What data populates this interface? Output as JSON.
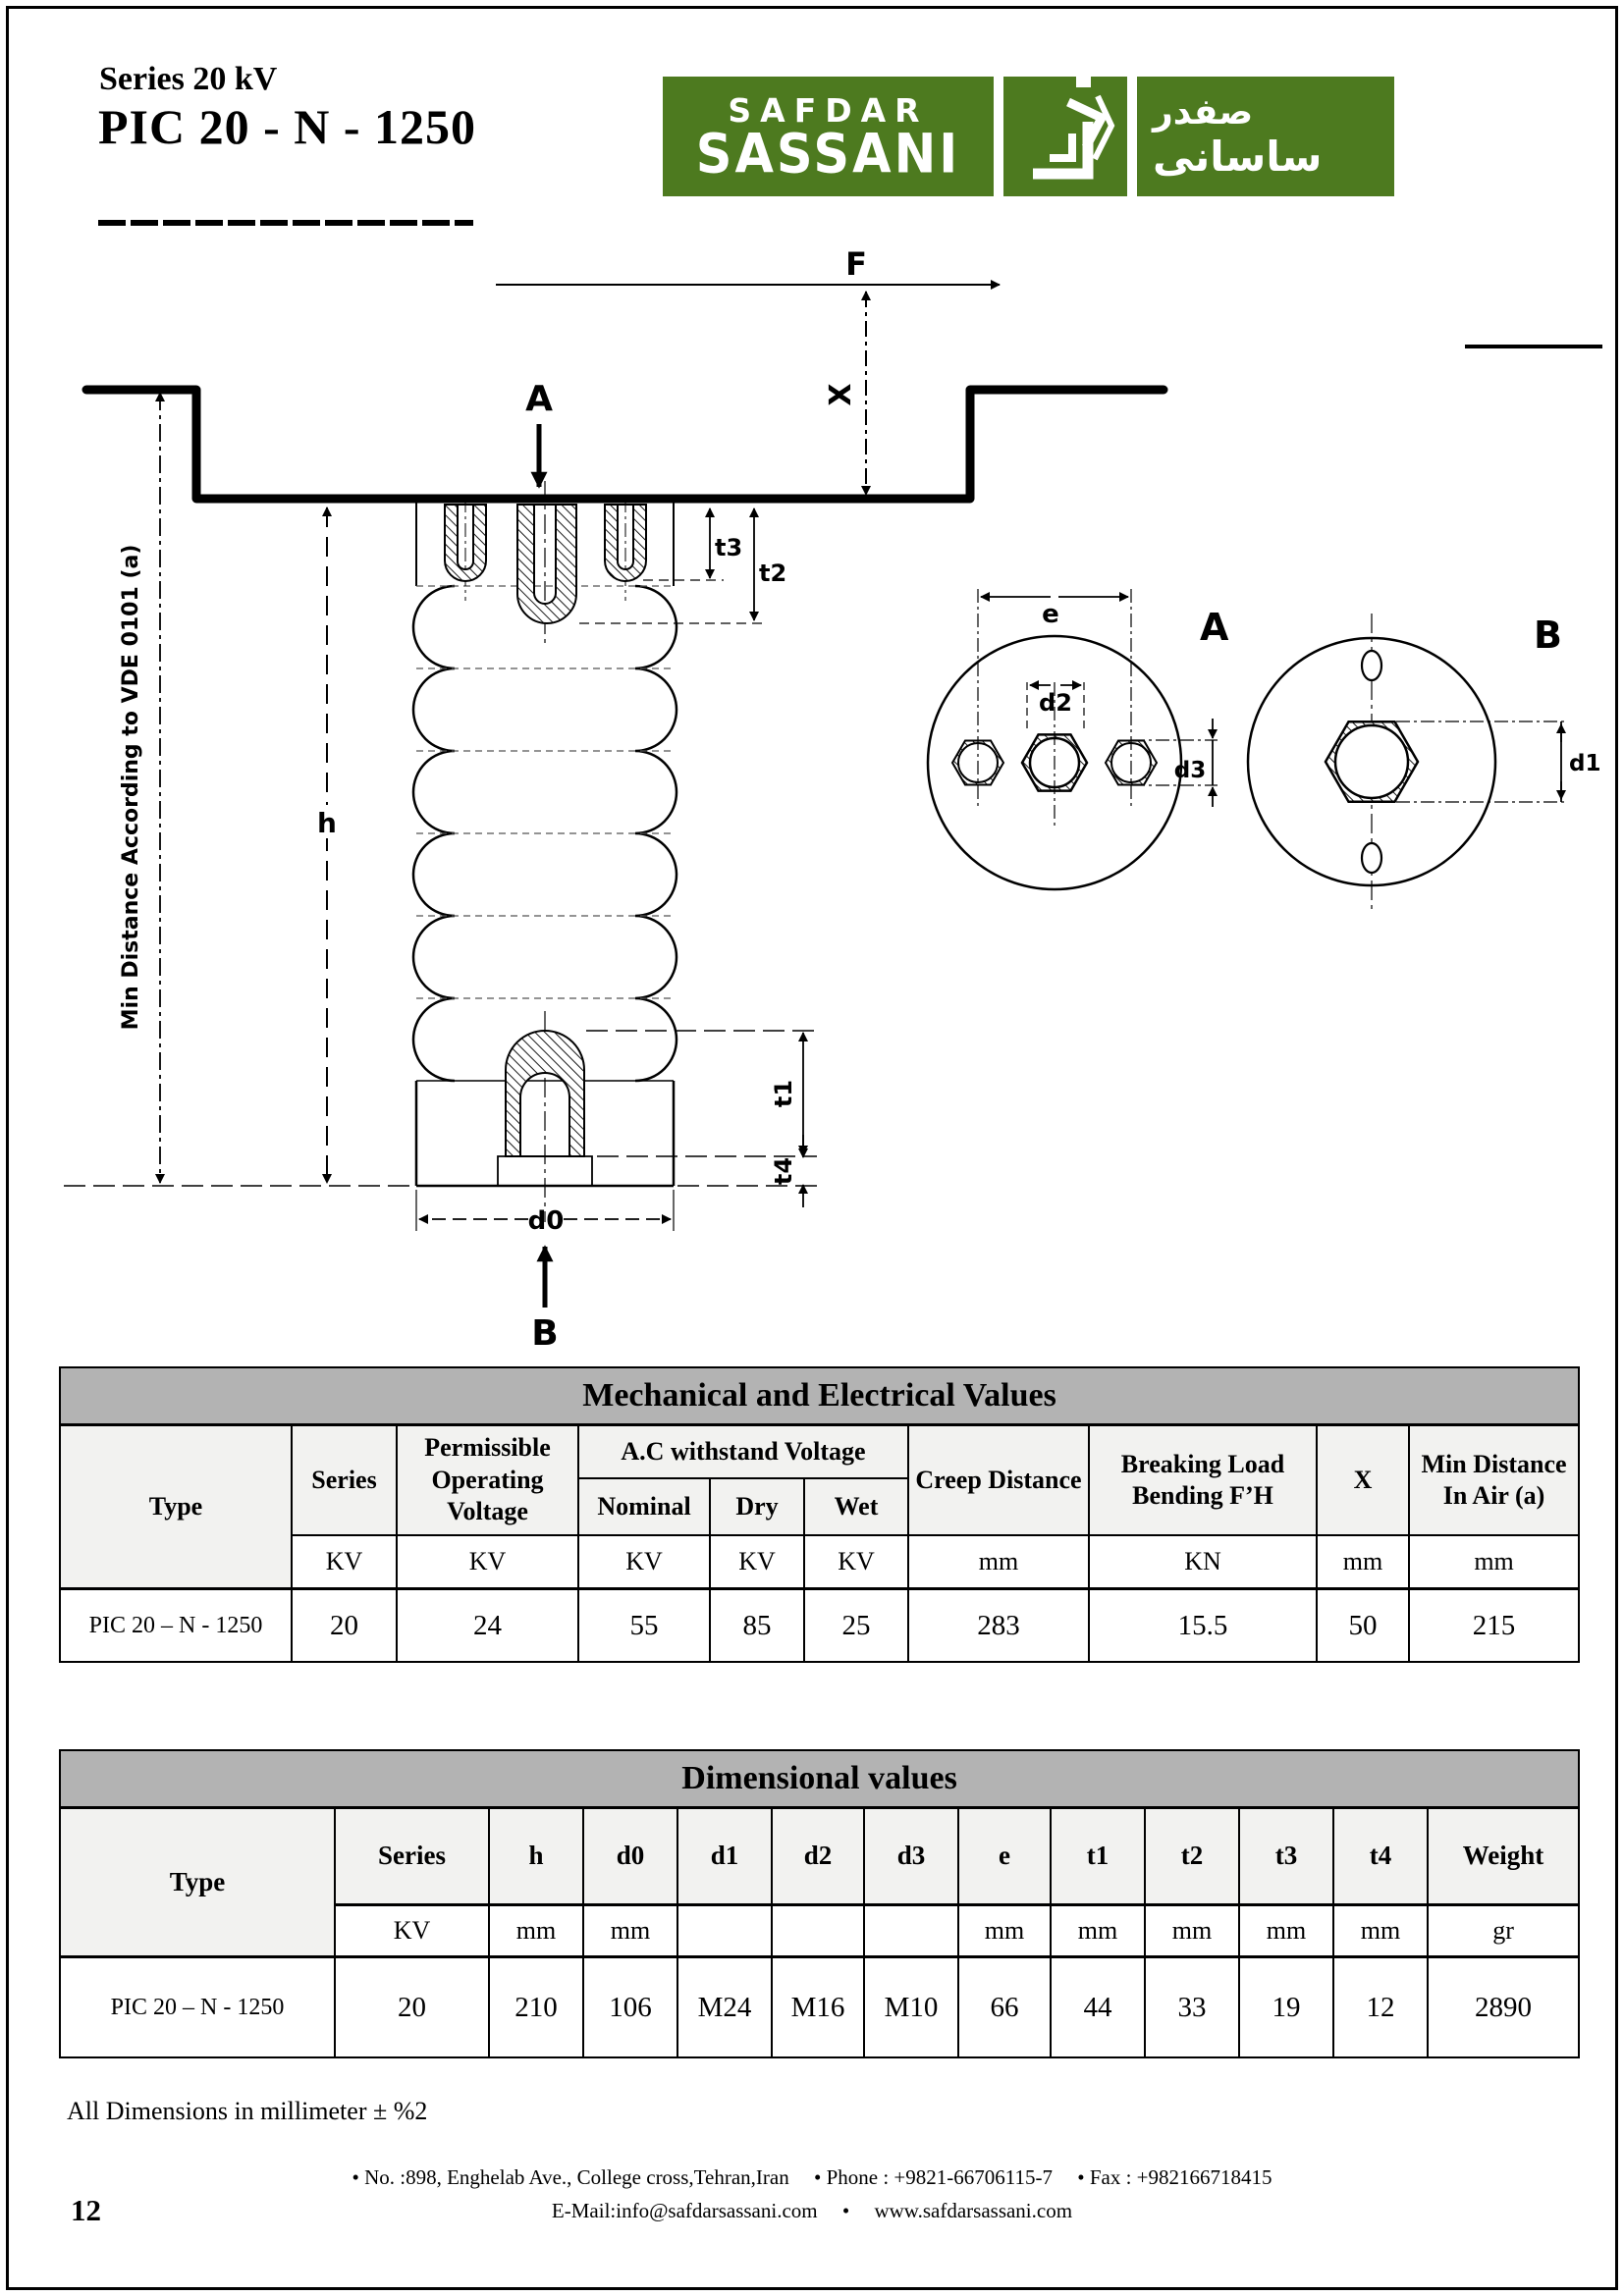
{
  "colors": {
    "brand_green": "#4d7a1f",
    "table_title_bg": "#b3b3b3",
    "table_header_bg": "#f2f2f0"
  },
  "header": {
    "series_title": "Series 20 kV",
    "product_title": "PIC 20 - N - 1250"
  },
  "logo": {
    "name_top": "SAFDAR",
    "name_bottom": "SASSANI",
    "arabic_top": "صفدر",
    "arabic_bottom": "ساسانی"
  },
  "drawing": {
    "labels": {
      "f": "F",
      "x": "X",
      "a": "A",
      "b": "B",
      "h": "h",
      "d0": "d0",
      "t1": "t1",
      "t2": "t2",
      "t3": "t3",
      "t4": "t4",
      "e": "e",
      "d1": "d1",
      "d2": "d2",
      "d3": "d3",
      "view_a": "A",
      "view_b": "B",
      "vde_note": "Min Distance According to VDE 0101 (a)"
    }
  },
  "mech_table": {
    "title": "Mechanical and Electrical Values",
    "cols": {
      "type": "Type",
      "series": "Series",
      "pov": "Permissible Operating Voltage",
      "acwv": "A.C withstand Voltage",
      "nominal": "Nominal",
      "dry": "Dry",
      "wet": "Wet",
      "creep": "Creep Distance",
      "breaking": "Breaking Load Bending F’H",
      "x": "X",
      "min_air": "Min Distance In Air (a)"
    },
    "units": [
      "KV",
      "KV",
      "KV",
      "KV",
      "KV",
      "mm",
      "KN",
      "mm",
      "mm"
    ],
    "row": [
      "PIC 20 – N - 1250",
      "20",
      "24",
      "55",
      "85",
      "25",
      "283",
      "15.5",
      "50",
      "215"
    ]
  },
  "dim_table": {
    "title": "Dimensional values",
    "type_col": "Type",
    "cols": [
      "Series",
      "h",
      "d0",
      "d1",
      "d2",
      "d3",
      "e",
      "t1",
      "t2",
      "t3",
      "t4",
      "Weight"
    ],
    "units": [
      "KV",
      "mm",
      "mm",
      "",
      "",
      "",
      "mm",
      "mm",
      "mm",
      "mm",
      "mm",
      "gr"
    ],
    "row": [
      "PIC 20 – N - 1250",
      "20",
      "210",
      "106",
      "M24",
      "M16",
      "M10",
      "66",
      "44",
      "33",
      "19",
      "12",
      "2890"
    ]
  },
  "notes": {
    "dimensions_note": "All Dimensions in millimeter ± %2"
  },
  "footer": {
    "address": "•  No. :898, Enghelab Ave., College cross,Tehran,Iran",
    "phone": "•  Phone : +9821-66706115-7",
    "fax": "•  Fax : +982166718415",
    "email": "E-Mail:info@safdarsassani.com",
    "bullet": "•",
    "website": "www.safdarsassani.com",
    "page_number": "12"
  }
}
